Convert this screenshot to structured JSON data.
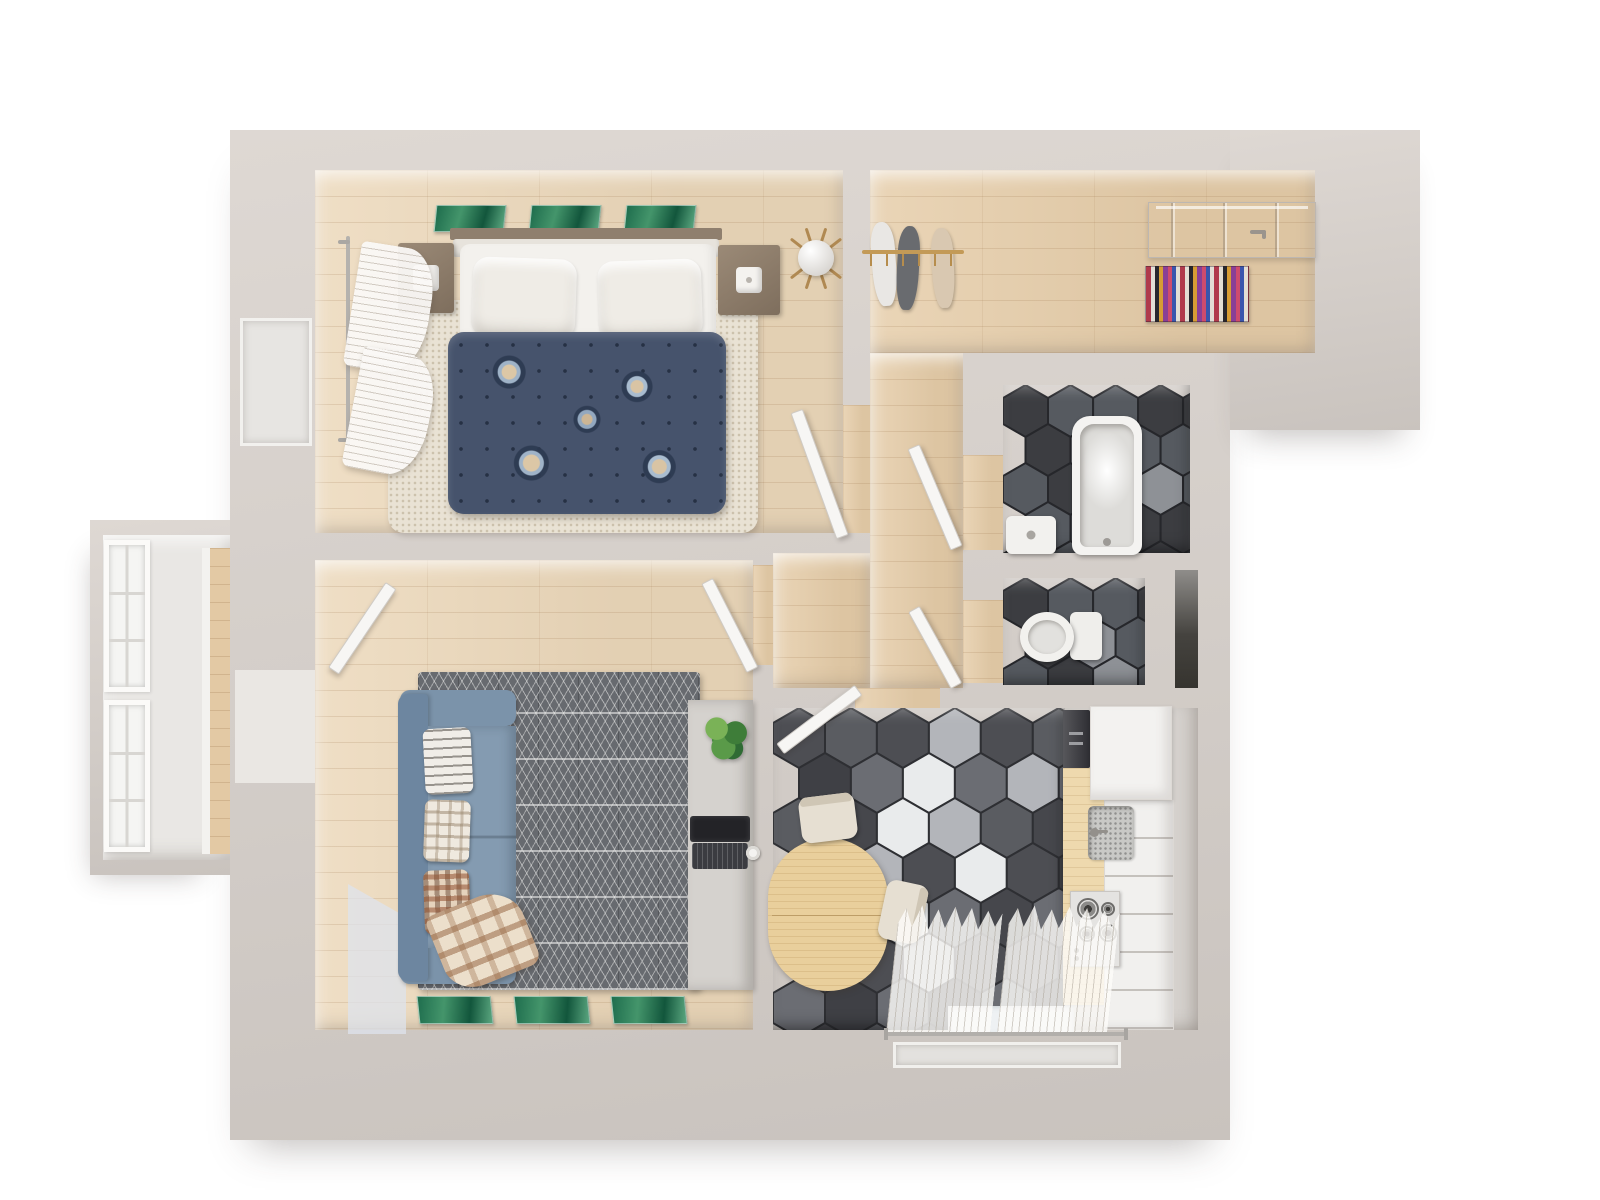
{
  "scene": {
    "kind": "3d-rendered floor plan, top-down view, one-bedroom apartment",
    "visible_text": "none"
  },
  "palette": {
    "outside": "#ffffff",
    "wall": "#d3cdc8",
    "wall_hi": "#ded8d3",
    "wood": "#ecd8ba",
    "wood_hall": "#e6cda9",
    "rug_bed": "#e9e2d4",
    "rug_living": "#676a6f",
    "sofa": "#7b93aa",
    "sofa_dark": "#6d86a0",
    "cushion": "#849bb1",
    "duvet": "#46536c",
    "mattress": "#f3f1ed",
    "pillow": "#efece6",
    "table": "#e9cf9c",
    "counter": "#eed9ae",
    "brass": "#c39a57",
    "rug_a": "#b03a4c",
    "rug_b": "#e3ded5",
    "rug_c": "#27262c",
    "rug_d": "#d79c34",
    "rug_e": "#8a3f96",
    "rug_f": "#cf4b6e",
    "rug_g": "#3a55ad",
    "painting_green_dark": "#12563c",
    "painting_green_light": "#5aa67f"
  },
  "hex_floors": {
    "kitchen": {
      "s": 30,
      "shades": [
        "#4d4e53",
        "#5a5c61",
        "#46474c",
        "#6b6d73",
        "#3f4045"
      ],
      "grout": "#2e2f33",
      "white_color": "#e9ebec",
      "light_color": "#b3b5ba",
      "white": [
        [
          2,
          1
        ],
        [
          2,
          2
        ],
        [
          3,
          3
        ],
        [
          2,
          4
        ]
      ],
      "light": [
        [
          3,
          2
        ],
        [
          1,
          3
        ],
        [
          3,
          0
        ],
        [
          2,
          5
        ],
        [
          4,
          1
        ]
      ]
    },
    "bathroom": {
      "s": 26,
      "shades": [
        "#3c3d41",
        "#4a4c51",
        "#565a60",
        "#333438"
      ],
      "grout": "#26272b",
      "white_color": "#e9ebec",
      "light_color": "#8e9196",
      "white": [],
      "light": [
        [
          1,
          1
        ],
        [
          3,
          2
        ]
      ]
    },
    "wc": {
      "s": 26,
      "shades": [
        "#3c3d41",
        "#4a4c51",
        "#565a60",
        "#333438"
      ],
      "grout": "#26272b",
      "white_color": "#e9ebec",
      "light_color": "#8e9196",
      "white": [],
      "light": [
        [
          1,
          1
        ],
        [
          2,
          2
        ]
      ]
    }
  },
  "rooms": [
    {
      "id": "bedroom",
      "floor": "wood",
      "furniture": [
        "double-bed",
        "duvet-floral",
        "two-pillows",
        "nightstand-left",
        "nightstand-right",
        "table-lamps",
        "tripod-floor-lamp",
        "shag-rug",
        "three-green-paintings",
        "window-curtains"
      ]
    },
    {
      "id": "entry-hall",
      "floor": "wood",
      "furniture": [
        "coat-rack-with-clothes",
        "striped-doormat",
        "front-door"
      ]
    },
    {
      "id": "corridor",
      "floor": "wood",
      "furniture": []
    },
    {
      "id": "bathroom",
      "floor": "dark-hex-tile",
      "furniture": [
        "bathtub",
        "washbasin"
      ]
    },
    {
      "id": "wc",
      "floor": "dark-hex-tile",
      "furniture": [
        "toilet"
      ]
    },
    {
      "id": "closet-niche",
      "floor": "dark",
      "furniture": []
    },
    {
      "id": "kitchen",
      "floor": "hex-tile-mixed",
      "furniture": [
        "oval-dining-table",
        "two-chairs",
        "counter-with-sink",
        "gas-stove",
        "white-cabinets",
        "tall-appliance",
        "sheer-curtains",
        "window"
      ]
    },
    {
      "id": "living-room",
      "floor": "wood",
      "furniture": [
        "blue-sofa",
        "three-pillows",
        "plaid-blanket",
        "geometric-rug",
        "desk",
        "laptop",
        "plant",
        "mug",
        "three-green-paintings",
        "balcony-door"
      ]
    },
    {
      "id": "balcony",
      "floor": "wood-strip",
      "furniture": [
        "two-tall-windows"
      ]
    }
  ],
  "doors": [
    "front-door",
    "bedroom-door",
    "bathroom-door",
    "wc-door",
    "kitchen-door",
    "living-room-door",
    "balcony-door"
  ]
}
